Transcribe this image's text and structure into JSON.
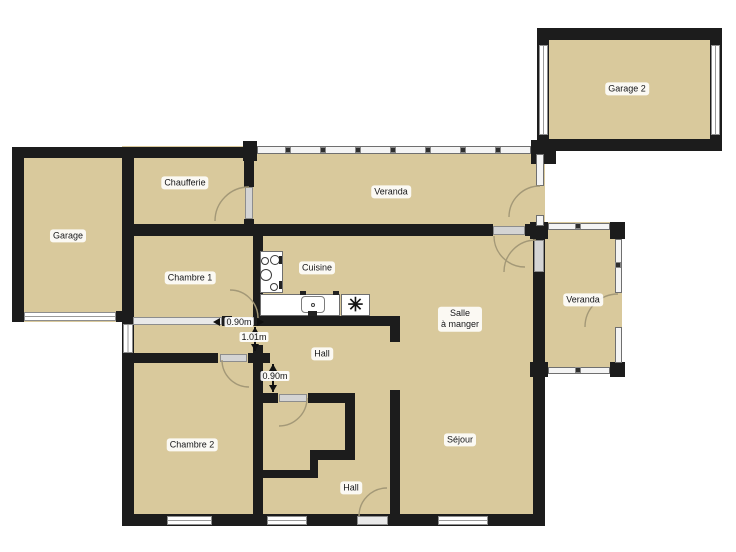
{
  "colors": {
    "room_fill": "#d9c99c",
    "wall": "#1c1c1c",
    "window_line": "#9a9a9a",
    "door_leaf": "#d4d4d4",
    "arc": "#a39877",
    "label_text": "#151515"
  },
  "rooms": [
    {
      "name": "room-area-main-house",
      "x": 122,
      "y": 146,
      "w": 423,
      "h": 380
    },
    {
      "name": "room-area-garage",
      "x": 12,
      "y": 147,
      "w": 122,
      "h": 175
    },
    {
      "name": "room-area-garage2",
      "x": 537,
      "y": 28,
      "w": 185,
      "h": 123
    },
    {
      "name": "room-area-veranda-right",
      "x": 533,
      "y": 222,
      "w": 89,
      "h": 148
    }
  ],
  "walls": [
    {
      "name": "wall-garage-left",
      "x": 12,
      "y": 147,
      "w": 12,
      "h": 175
    },
    {
      "name": "wall-garage-top",
      "x": 12,
      "y": 147,
      "w": 122,
      "h": 11
    },
    {
      "name": "wall-garage-bottom-left",
      "x": 12,
      "y": 311,
      "w": 12,
      "h": 11
    },
    {
      "name": "wall-garage-bottom-right",
      "x": 116,
      "y": 311,
      "w": 18,
      "h": 11
    },
    {
      "name": "wall-main-left",
      "x": 122,
      "y": 147,
      "w": 12,
      "h": 379
    },
    {
      "name": "wall-main-top",
      "x": 134,
      "y": 147,
      "w": 123,
      "h": 11
    },
    {
      "name": "wall-chaufferie-veranda-upper",
      "x": 244,
      "y": 147,
      "w": 10,
      "h": 40
    },
    {
      "name": "wall-chaufferie-veranda-lower",
      "x": 244,
      "y": 219,
      "w": 10,
      "h": 7
    },
    {
      "name": "wall-mid-horizontal-left",
      "x": 122,
      "y": 224,
      "w": 371,
      "h": 12
    },
    {
      "name": "wall-mid-horizontal-right",
      "x": 525,
      "y": 224,
      "w": 20,
      "h": 12
    },
    {
      "name": "wall-main-right",
      "x": 533,
      "y": 236,
      "w": 12,
      "h": 278
    },
    {
      "name": "wall-main-bottom",
      "x": 122,
      "y": 514,
      "w": 423,
      "h": 12
    },
    {
      "name": "wall-chambre1-bottom-a",
      "x": 222,
      "y": 316,
      "w": 10,
      "h": 10
    },
    {
      "name": "wall-kitchen-bottom",
      "x": 253,
      "y": 316,
      "w": 147,
      "h": 10
    },
    {
      "name": "wall-chambre1-cuisine",
      "x": 253,
      "y": 236,
      "w": 10,
      "h": 80
    },
    {
      "name": "wall-hall-right-upper",
      "x": 390,
      "y": 316,
      "w": 10,
      "h": 26
    },
    {
      "name": "wall-hall-sejour",
      "x": 390,
      "y": 390,
      "w": 10,
      "h": 124
    },
    {
      "name": "wall-chambre2-top-left",
      "x": 122,
      "y": 353,
      "w": 96,
      "h": 10
    },
    {
      "name": "wall-chambre2-top-right",
      "x": 248,
      "y": 353,
      "w": 22,
      "h": 10
    },
    {
      "name": "wall-chambre2-right",
      "x": 253,
      "y": 345,
      "w": 10,
      "h": 170
    },
    {
      "name": "wall-wc-top-left",
      "x": 262,
      "y": 393,
      "w": 16,
      "h": 10
    },
    {
      "name": "wall-wc-top-right",
      "x": 308,
      "y": 393,
      "w": 47,
      "h": 10
    },
    {
      "name": "wall-wc-right",
      "x": 345,
      "y": 393,
      "w": 10,
      "h": 67
    },
    {
      "name": "wall-wc-step-h",
      "x": 310,
      "y": 450,
      "w": 45,
      "h": 10
    },
    {
      "name": "wall-wc-step-v",
      "x": 310,
      "y": 450,
      "w": 8,
      "h": 28
    },
    {
      "name": "wall-wc-bottom",
      "x": 263,
      "y": 470,
      "w": 55,
      "h": 8
    },
    {
      "name": "wall-garage2-top",
      "x": 537,
      "y": 28,
      "w": 185,
      "h": 12
    },
    {
      "name": "wall-garage2-left",
      "x": 537,
      "y": 28,
      "w": 12,
      "h": 123
    },
    {
      "name": "wall-garage2-right",
      "x": 710,
      "y": 28,
      "w": 12,
      "h": 123
    },
    {
      "name": "wall-garage2-bottom",
      "x": 537,
      "y": 139,
      "w": 185,
      "h": 12
    },
    {
      "name": "wall-junction-post",
      "x": 531,
      "y": 140,
      "w": 25,
      "h": 24
    },
    {
      "name": "wall-veranda-post-left",
      "x": 243,
      "y": 141,
      "w": 14,
      "h": 20
    },
    {
      "name": "wall-veranda-right-post-tl",
      "x": 530,
      "y": 222,
      "w": 18,
      "h": 17
    },
    {
      "name": "wall-veranda-right-post-tr",
      "x": 610,
      "y": 222,
      "w": 15,
      "h": 17
    },
    {
      "name": "wall-veranda-right-post-br",
      "x": 610,
      "y": 362,
      "w": 15,
      "h": 15
    },
    {
      "name": "wall-veranda-right-post-bl",
      "x": 530,
      "y": 362,
      "w": 18,
      "h": 15
    }
  ],
  "windows": [
    {
      "name": "garage-door-opening",
      "o": "h",
      "x": 24,
      "y": 312,
      "w": 92,
      "h": 9
    },
    {
      "name": "corridor-window",
      "o": "v",
      "x": 123,
      "y": 324,
      "w": 10,
      "h": 29
    },
    {
      "name": "window-chambre2-south",
      "o": "h",
      "x": 167,
      "y": 516,
      "w": 45,
      "h": 9
    },
    {
      "name": "window-hall-south",
      "o": "h",
      "x": 267,
      "y": 516,
      "w": 40,
      "h": 9
    },
    {
      "name": "window-sejour-south",
      "o": "h",
      "x": 438,
      "y": 516,
      "w": 50,
      "h": 9
    },
    {
      "name": "window-garage2-left",
      "o": "v",
      "x": 539,
      "y": 45,
      "w": 9,
      "h": 90
    },
    {
      "name": "window-garage2-right",
      "o": "v",
      "x": 711,
      "y": 45,
      "w": 9,
      "h": 90
    }
  ],
  "glass": [
    {
      "name": "glass-wall-veranda-top",
      "x": 257,
      "y": 146,
      "w": 274,
      "h": 8
    },
    {
      "name": "glass-wall-veranda-top-right-a",
      "x": 536,
      "y": 154,
      "w": 8,
      "h": 32
    },
    {
      "name": "glass-wall-veranda-top-right-b",
      "x": 536,
      "y": 215,
      "w": 8,
      "h": 11
    },
    {
      "name": "glass-wall-veranda2-top",
      "x": 548,
      "y": 223,
      "w": 62,
      "h": 7
    },
    {
      "name": "glass-wall-veranda2-right-a",
      "x": 615,
      "y": 239,
      "w": 7,
      "h": 54
    },
    {
      "name": "glass-wall-veranda2-right-b",
      "x": 615,
      "y": 327,
      "w": 7,
      "h": 36
    },
    {
      "name": "glass-wall-veranda2-bottom",
      "x": 548,
      "y": 367,
      "w": 62,
      "h": 7
    }
  ],
  "glass_ticks": [
    {
      "name": "glass-tick",
      "x": 285,
      "y": 147,
      "w": 6,
      "h": 6
    },
    {
      "name": "glass-tick",
      "x": 320,
      "y": 147,
      "w": 6,
      "h": 6
    },
    {
      "name": "glass-tick",
      "x": 355,
      "y": 147,
      "w": 6,
      "h": 6
    },
    {
      "name": "glass-tick",
      "x": 390,
      "y": 147,
      "w": 6,
      "h": 6
    },
    {
      "name": "glass-tick",
      "x": 425,
      "y": 147,
      "w": 6,
      "h": 6
    },
    {
      "name": "glass-tick",
      "x": 460,
      "y": 147,
      "w": 6,
      "h": 6
    },
    {
      "name": "glass-tick",
      "x": 495,
      "y": 147,
      "w": 6,
      "h": 6
    },
    {
      "name": "glass-tick",
      "x": 575,
      "y": 223,
      "w": 6,
      "h": 6
    },
    {
      "name": "glass-tick",
      "x": 615,
      "y": 262,
      "w": 6,
      "h": 6
    },
    {
      "name": "glass-tick",
      "x": 575,
      "y": 367,
      "w": 6,
      "h": 6
    }
  ],
  "doors": [
    {
      "name": "door-leaf-chaufferie",
      "x": 245,
      "y": 187,
      "w": 8,
      "h": 32,
      "tone": "normal"
    },
    {
      "name": "closet-front-chambre1",
      "x": 133,
      "y": 317,
      "w": 89,
      "h": 8,
      "tone": "light"
    },
    {
      "name": "door-leaf-chambre1",
      "x": 230,
      "y": 317,
      "w": 24,
      "h": 8,
      "tone": "normal"
    },
    {
      "name": "door-leaf-chambre2",
      "x": 220,
      "y": 354,
      "w": 27,
      "h": 8,
      "tone": "normal"
    },
    {
      "name": "door-leaf-wc",
      "x": 279,
      "y": 394,
      "w": 28,
      "h": 8,
      "tone": "normal"
    },
    {
      "name": "door-leaf-veranda-salle",
      "x": 493,
      "y": 226,
      "w": 32,
      "h": 9,
      "tone": "normal"
    },
    {
      "name": "door-leaf-veranda2-salle",
      "x": 534,
      "y": 240,
      "w": 10,
      "h": 32,
      "tone": "normal"
    },
    {
      "name": "door-leaf-entrance",
      "x": 357,
      "y": 516,
      "w": 31,
      "h": 9,
      "tone": "light"
    }
  ],
  "arcs": [
    {
      "name": "door-arc-chaufferie",
      "d": "M 249 187 A 34 34 0 0 0 215 221"
    },
    {
      "name": "door-arc-veranda-top",
      "d": "M 540 186 A 31 31 0 0 0 509 217"
    },
    {
      "name": "door-arc-veranda-to-salle",
      "d": "M 494 236 A 31 31 0 0 0 525 267"
    },
    {
      "name": "door-arc-veranda2-to-salle",
      "d": "M 536 240 A 32 32 0 0 0 504 272"
    },
    {
      "name": "door-arc-veranda2-exterior",
      "d": "M 618 294 A 33 33 0 0 0 585 327"
    },
    {
      "name": "door-arc-chambre1",
      "d": "M 230 290 A 28 28 0 0 1 258 318"
    },
    {
      "name": "door-arc-chambre2",
      "d": "M 249 387 A 27 27 0 0 1 222 360"
    },
    {
      "name": "door-arc-wc",
      "d": "M 279 426 A 28 28 0 0 0 307 398"
    },
    {
      "name": "door-arc-entrance",
      "d": "M 387 488 A 28 28 0 0 0 359 516"
    }
  ],
  "labels": [
    {
      "name": "room-label-garage",
      "text": "Garage",
      "x": 68,
      "y": 236
    },
    {
      "name": "room-label-chaufferie",
      "text": "Chaufferie",
      "x": 185,
      "y": 183
    },
    {
      "name": "room-label-veranda-top",
      "text": "Veranda",
      "x": 391,
      "y": 192
    },
    {
      "name": "room-label-garage2",
      "text": "Garage 2",
      "x": 627,
      "y": 89
    },
    {
      "name": "room-label-chambre1",
      "text": "Chambre 1",
      "x": 190,
      "y": 278
    },
    {
      "name": "room-label-cuisine",
      "text": "Cuisine",
      "x": 317,
      "y": 268
    },
    {
      "name": "room-label-salle-a-manger",
      "text": "Salle\nà manger",
      "x": 460,
      "y": 319
    },
    {
      "name": "room-label-veranda-right",
      "text": "Veranda",
      "x": 583,
      "y": 300
    },
    {
      "name": "room-label-hall-upper",
      "text": "Hall",
      "x": 322,
      "y": 354
    },
    {
      "name": "room-label-chambre2",
      "text": "Chambre 2",
      "x": 192,
      "y": 445
    },
    {
      "name": "room-label-sejour",
      "text": "Séjour",
      "x": 460,
      "y": 440
    },
    {
      "name": "room-label-hall-lower",
      "text": "Hall",
      "x": 351,
      "y": 488
    }
  ],
  "measurements": [
    {
      "name": "measure-door-chambre1",
      "text": "0.90m",
      "x": 239,
      "y": 322,
      "arrows": [
        {
          "x": 220,
          "y": 322,
          "dir": "left"
        },
        {
          "x": 257,
          "y": 322,
          "dir": "right"
        }
      ],
      "lines": []
    },
    {
      "name": "measure-corridor-width",
      "text": "1.01m",
      "x": 254,
      "y": 337,
      "arrows": [
        {
          "x": 255,
          "y": 327,
          "dir": "up"
        },
        {
          "x": 255,
          "y": 344,
          "dir": "down"
        }
      ],
      "lines": [
        {
          "x": 254,
          "y": 327,
          "w": 1.5,
          "h": 24
        }
      ]
    },
    {
      "name": "measure-hall-passage",
      "text": "0.90m",
      "x": 275,
      "y": 376,
      "arrows": [
        {
          "x": 273,
          "y": 364,
          "dir": "up"
        },
        {
          "x": 273,
          "y": 385,
          "dir": "down"
        }
      ],
      "lines": [
        {
          "x": 272,
          "y": 364,
          "w": 1.5,
          "h": 28
        }
      ]
    }
  ],
  "fixtures": {
    "stove_box": {
      "name": "stove",
      "x": 260,
      "y": 251,
      "w": 23,
      "h": 42
    },
    "burners": [
      {
        "cx": 265,
        "cy": 261,
        "r": 4
      },
      {
        "cx": 275,
        "cy": 260,
        "r": 5
      },
      {
        "cx": 266,
        "cy": 275,
        "r": 6
      },
      {
        "cx": 274,
        "cy": 287,
        "r": 4
      }
    ],
    "knobs": [
      {
        "x": 279,
        "y": 256,
        "w": 3,
        "h": 8
      },
      {
        "x": 279,
        "y": 281,
        "w": 3,
        "h": 8
      }
    ],
    "counter": {
      "name": "kitchen-counter",
      "x": 260,
      "y": 294,
      "w": 80,
      "h": 22
    },
    "sink": {
      "name": "kitchen-sink",
      "x": 301,
      "y": 296,
      "w": 24,
      "h": 17
    },
    "sink_tap": {
      "x": 308,
      "y": 311,
      "w": 9,
      "h": 5
    },
    "sink_drain": {
      "cx": 313,
      "cy": 305,
      "r": 2
    },
    "counter_marks": [
      {
        "x": 300,
        "y": 291,
        "w": 6,
        "h": 4
      },
      {
        "x": 333,
        "y": 291,
        "w": 6,
        "h": 4
      }
    ],
    "appliance": {
      "name": "kitchen-appliance",
      "x": 341,
      "y": 294,
      "w": 29,
      "h": 22,
      "glyph": "✳"
    }
  }
}
